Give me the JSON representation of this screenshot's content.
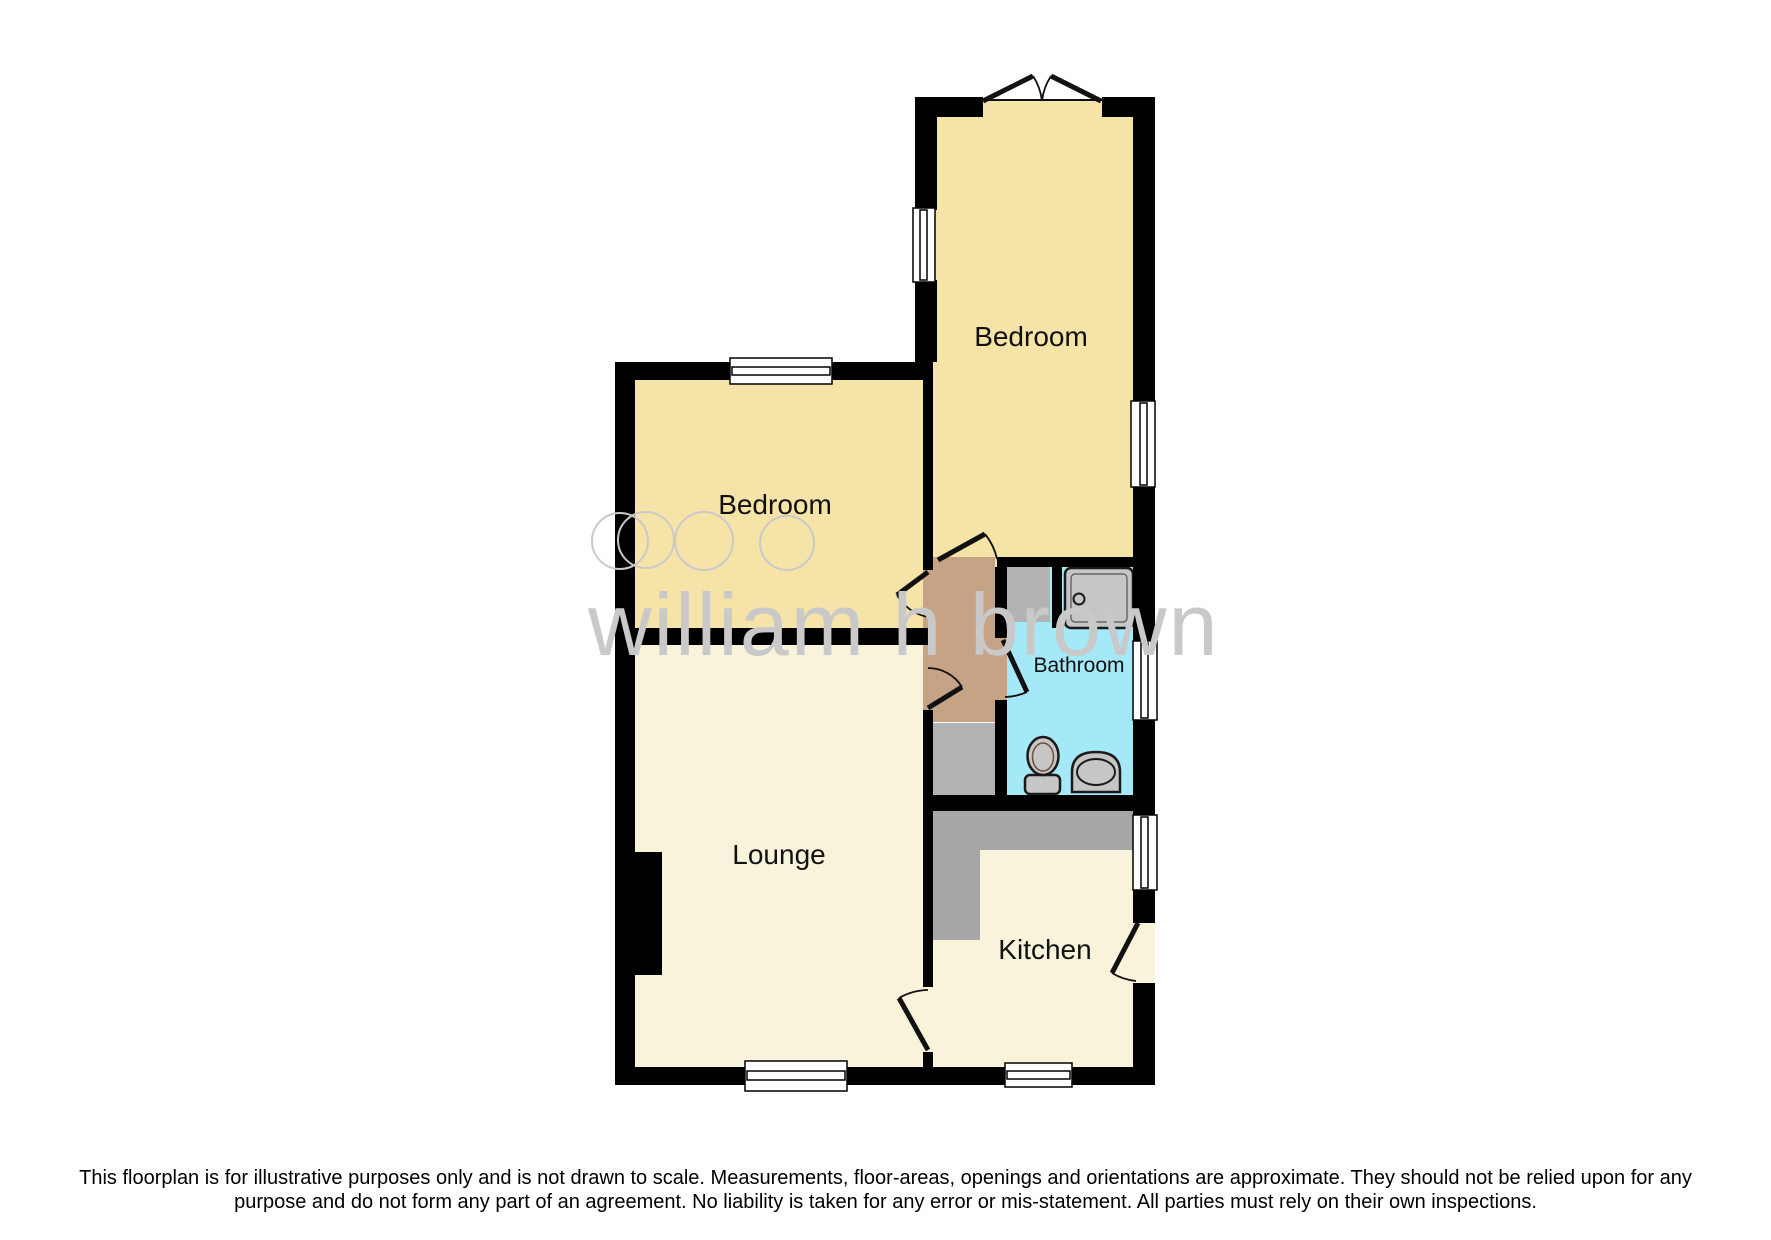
{
  "watermark": {
    "text": "william h brown"
  },
  "rooms": {
    "bedroom_top": {
      "label": "Bedroom"
    },
    "bedroom_left": {
      "label": "Bedroom"
    },
    "bathroom": {
      "label": "Bathroom"
    },
    "lounge": {
      "label": "Lounge"
    },
    "kitchen": {
      "label": "Kitchen"
    }
  },
  "disclaimer": {
    "line1": "This floorplan is for illustrative purposes only and is not drawn to scale. Measurements, floor-areas, openings and orientations are approximate. They should not be relied upon for any",
    "line2": "purpose and do not form any part of an agreement. No liability is taken for any error or mis-statement. All parties must rely on their own inspections."
  },
  "colors": {
    "wall": "#000000",
    "bedroom_fill": "#f6e3a7",
    "lounge_fill": "#faf3dc",
    "kitchen_fill": "#faf3dc",
    "bathroom_fill": "#a5e8f8",
    "hall_fill": "#c7a386",
    "counter_gray": "#a6a6a6",
    "cupboard_gray": "#b3b3b3",
    "fixture_gray": "#c6c6c6",
    "window_fill": "#ffffff",
    "watermark_gray": "#c9c9c9"
  }
}
